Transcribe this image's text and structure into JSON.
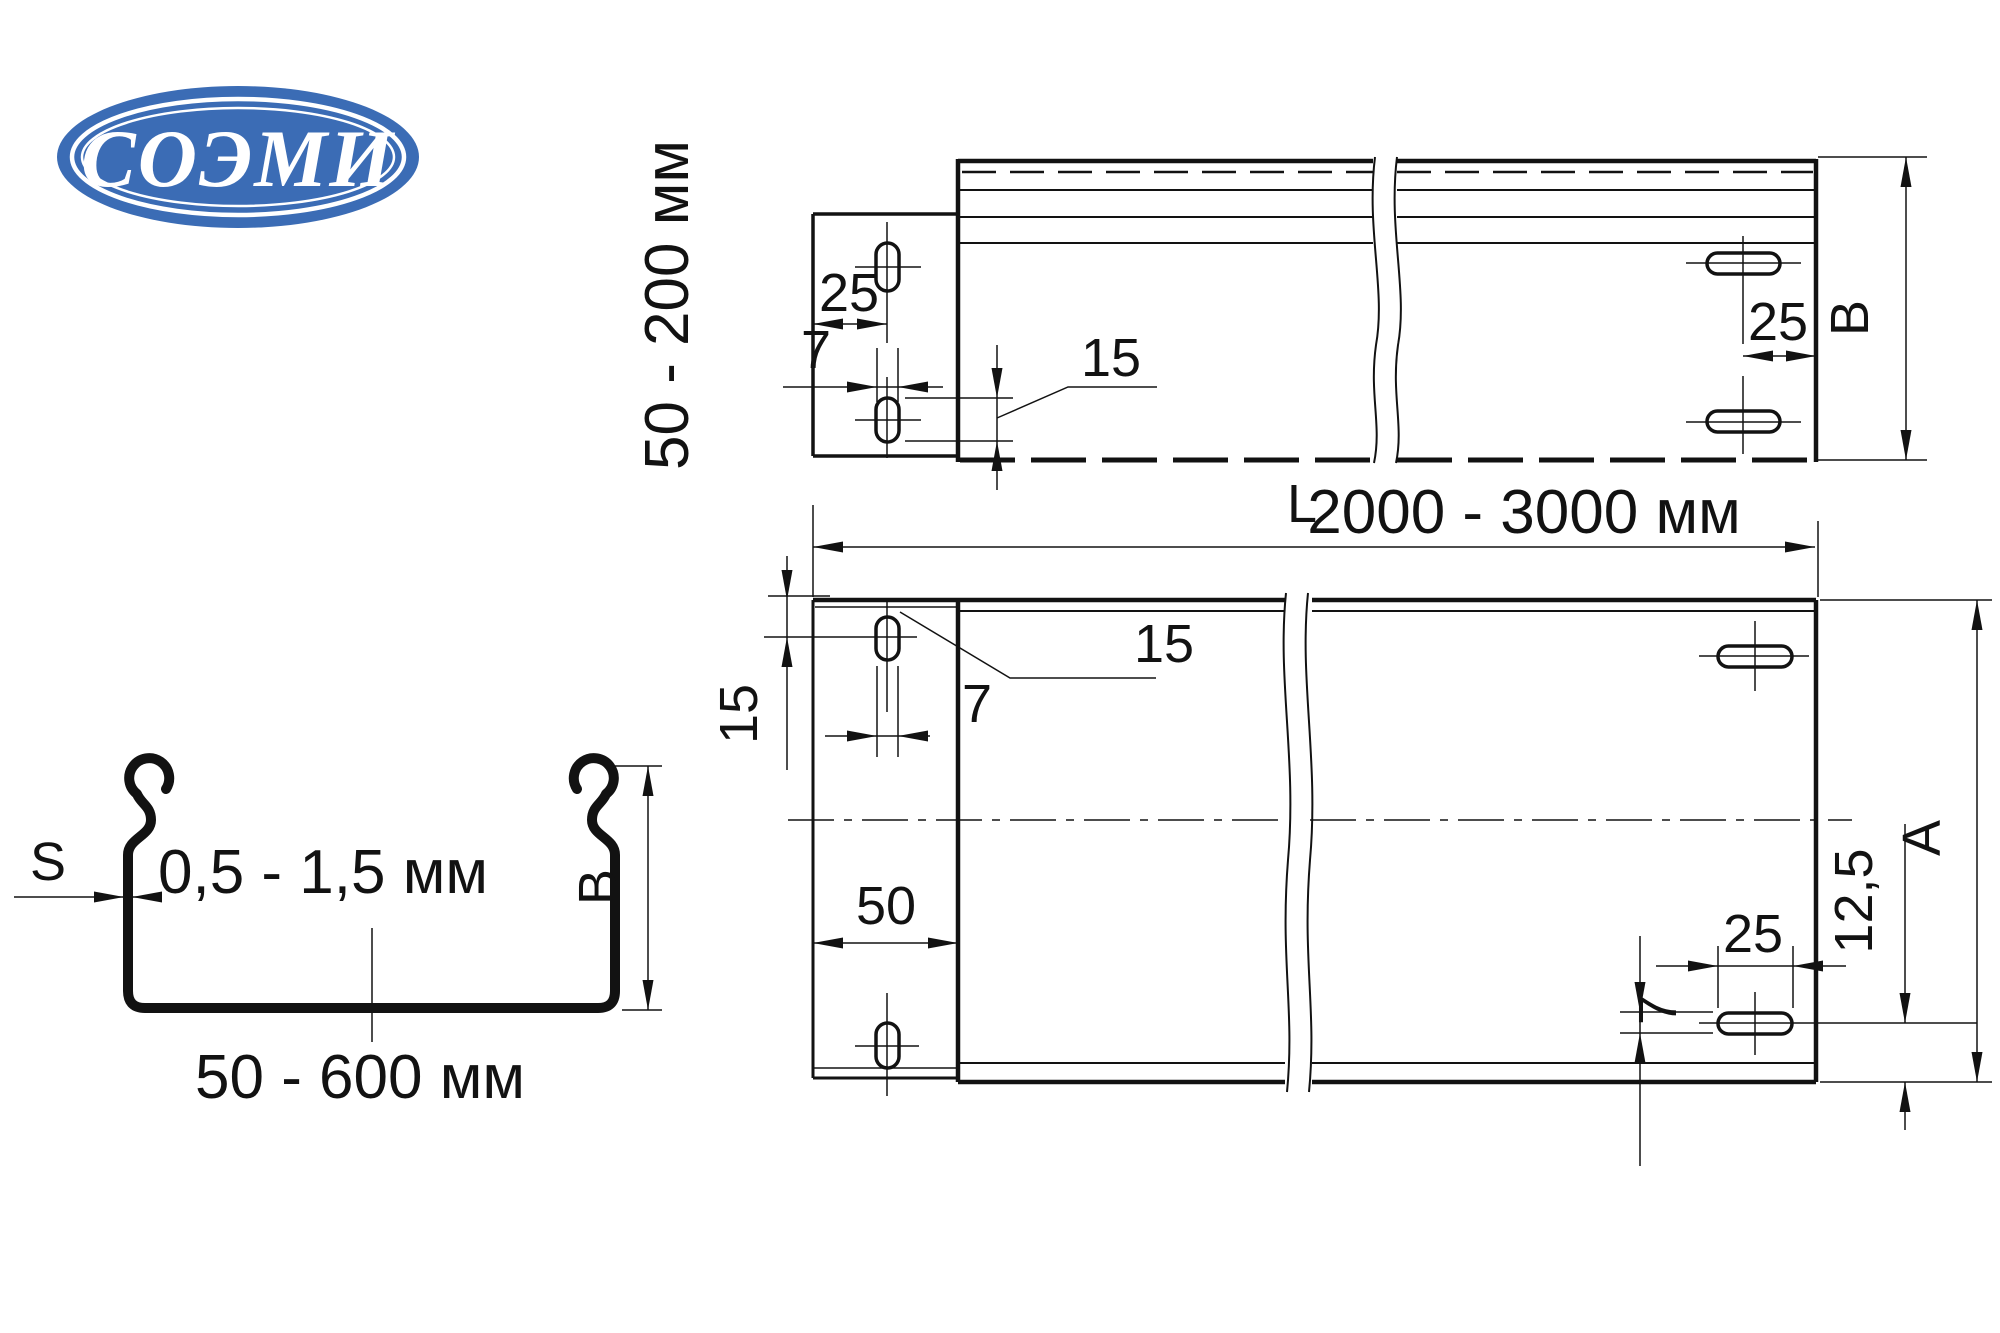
{
  "logo": {
    "text": "СОЭМИ",
    "bg_color": "#3b6cb5",
    "fg_color": "#ffffff"
  },
  "side_view": {
    "height_label": "50 - 200 мм",
    "dim_hole_pitch": "25",
    "dim_slot_width": "7",
    "dim_slot_length": "15",
    "dim_end_hole_offset": "25",
    "width_letter": "B"
  },
  "length_dim": {
    "prefix": "L",
    "value": "2000 - 3000 мм"
  },
  "plan_view": {
    "dim_slot_length": "15",
    "dim_slot_width_tab": "7",
    "dim_edge_offset": "15",
    "dim_tab_length": "50",
    "dim_slot_width_end": "7",
    "dim_end_slot_length": "25",
    "dim_slot_edge_offset": "12,5",
    "width_letter": "A"
  },
  "cross_section": {
    "thickness_letter": "S",
    "thickness_range": "0,5 - 1,5 мм",
    "height_letter": "B",
    "width_range": "50 - 600 мм"
  }
}
